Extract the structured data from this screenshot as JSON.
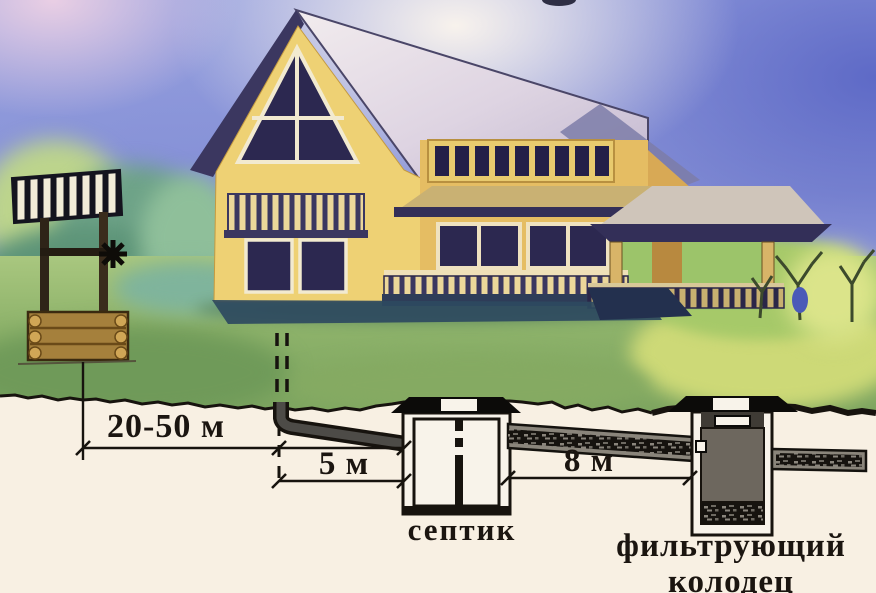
{
  "scene": {
    "description": "Watercolor illustration of a country house, a water well and an underground septic system cross-section with sanitary distance requirements"
  },
  "dimensions": [
    {
      "id": "well-to-sewer-outlet",
      "label": "20-50 м"
    },
    {
      "id": "sewer-outlet-to-septic",
      "label": "5 м"
    },
    {
      "id": "septic-to-filter-well",
      "label": "8 м"
    }
  ],
  "labels": {
    "septic_tank": "септик",
    "filter_well_line1": "фильтрующий",
    "filter_well_line2": "колодец"
  },
  "colors": {
    "sky_blue": "#8d97d8",
    "grass_green": "#8db26a",
    "house_yellow": "#ecd173",
    "roof_gray": "#ddd5e2",
    "underground_cream": "#f8f0e3",
    "outline_black": "#17130e",
    "mound_black": "#0c0b09",
    "filter_well_gray": "#6d675e"
  }
}
